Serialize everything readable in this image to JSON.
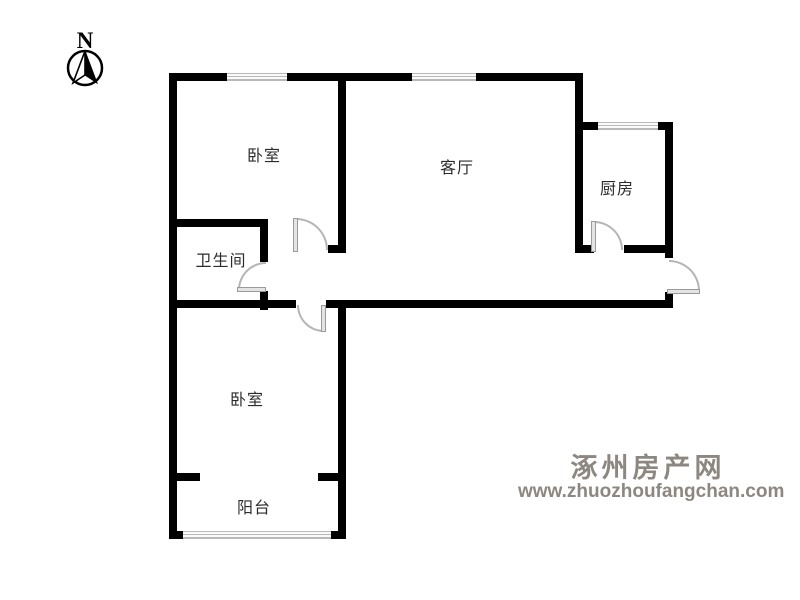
{
  "compass": {
    "label": "N"
  },
  "rooms": {
    "bedroom_top": {
      "label": "卧室"
    },
    "living": {
      "label": "客厅"
    },
    "kitchen": {
      "label": "厨房"
    },
    "bathroom": {
      "label": "卫生间"
    },
    "bedroom_bottom": {
      "label": "卧室"
    },
    "balcony": {
      "label": "阳台"
    }
  },
  "watermark": {
    "site_name": "涿州房产网",
    "site_url": "www.zhuozhoufangchan.com",
    "color": "#8d8781"
  },
  "colors": {
    "wall": "#000000",
    "door_arc": "#b5b5b5",
    "door_leaf": "#e4e4e4",
    "window_line": "#b9b9b9"
  }
}
